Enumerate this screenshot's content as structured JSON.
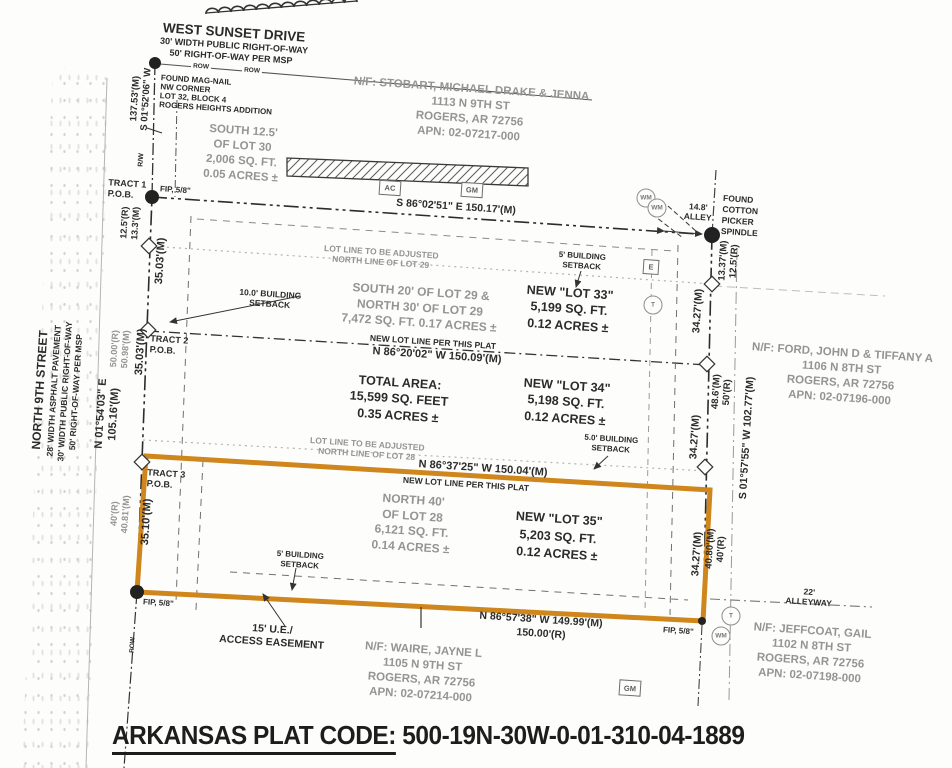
{
  "plat_code": {
    "label": "ARKANSAS PLAT CODE:",
    "value": "500-19N-30W-0-01-310-04-1889"
  },
  "streets": {
    "west_sunset": {
      "name": "WEST SUNSET DRIVE",
      "sub1": "30' WIDTH PUBLIC RIGHT-OF-WAY",
      "sub2": "50' RIGHT-OF-WAY PER MSP"
    },
    "north_9th": {
      "name": "NORTH 9TH STREET",
      "sub1": "28' WIDTH ASPHALT PAVEMENT",
      "sub2": "30' WIDTH PUBLIC RIGHT-OF-WAY",
      "sub3": "50' RIGHT-OF-WAY PER MSP"
    },
    "row": "ROW",
    "rw": "R/W",
    "alley": {
      "line1": "14.8'",
      "line2": "ALLEY"
    },
    "alleyway": {
      "line1": "22'",
      "line2": "ALLEYWAY"
    }
  },
  "corners": {
    "mag_nail": [
      "FOUND MAG-NAIL",
      "NW CORNER",
      "LOT 32, BLOCK 4",
      "ROGERS HEIGHTS ADDITION"
    ],
    "spindle": [
      "FOUND",
      "COTTON",
      "PICKER",
      "SPINDLE"
    ],
    "fip": "FIP, 5/8\""
  },
  "tracts": {
    "t1": {
      "line1": "TRACT 1",
      "line2": "P.O.B."
    },
    "t2": {
      "line1": "TRACT 2",
      "line2": "P.O.B."
    },
    "t3": {
      "line1": "TRACT 3",
      "line2": "P.O.B."
    }
  },
  "neighbors": {
    "stobart": [
      "N/F: STOBART, MICHAEL DRAKE & JENNA",
      "1113 N 9TH ST",
      "ROGERS, AR 72756",
      "APN: 02-07217-000"
    ],
    "ford": [
      "N/F: FORD, JOHN D & TIFFANY A",
      "1106 N 8TH ST",
      "ROGERS, AR 72756",
      "APN: 02-07196-000"
    ],
    "waire": [
      "N/F: WAIRE, JAYNE L",
      "1105 N 9TH ST",
      "ROGERS, AR 72756",
      "APN: 02-07214-000"
    ],
    "jeffcoat": [
      "N/F: JEFFCOAT, GAIL",
      "1102 N 8TH ST",
      "ROGERS, AR 72756",
      "APN: 02-07198-000"
    ]
  },
  "lots": {
    "lot30": [
      "SOUTH 12.5'",
      "OF LOT 30",
      "2,006 SQ. FT.",
      "0.05 ACRES ±"
    ],
    "lot29": [
      "SOUTH 20' OF LOT 29 &",
      "NORTH 30' OF LOT 29",
      "7,472 SQ. FT. 0.17 ACRES ±"
    ],
    "lot28": [
      "NORTH 40'",
      "OF LOT 28",
      "6,121 SQ. FT.",
      "0.14 ACRES ±"
    ],
    "new33": [
      "NEW \"LOT 33\"",
      "5,199 SQ. FT.",
      "0.12 ACRES ±"
    ],
    "new34": [
      "NEW \"LOT 34\"",
      "5,198 SQ. FT.",
      "0.12 ACRES ±"
    ],
    "new35": [
      "NEW \"LOT 35\"",
      "5,203 SQ. FT.",
      "0.12 ACRES ±"
    ],
    "total": [
      "TOTAL AREA:",
      "15,599 SQ. FEET",
      "0.35 ACRES ±"
    ]
  },
  "notes": {
    "adjust29": {
      "line1": "LOT LINE TO BE ADJUSTED",
      "line2": "NORTH LINE OF LOT 29"
    },
    "adjust28": {
      "line1": "LOT LINE TO BE ADJUSTED",
      "line2": "NORTH LINE OF LOT 28"
    },
    "new_lot_line": "NEW LOT LINE PER THIS PLAT",
    "setback10": {
      "line1": "10.0' BUILDING",
      "line2": "SETBACK"
    },
    "setback5a": {
      "line1": "5' BUILDING",
      "line2": "SETBACK"
    },
    "setback5b": {
      "line1": "5.0' BUILDING",
      "line2": "SETBACK"
    },
    "easement": {
      "line1": "15' U.E./",
      "line2": "ACCESS EASEMENT"
    }
  },
  "bearings": {
    "north": "S 86°02'51\" E  150.17'(M)",
    "lot29_new": "N 86°20'02\" W  150.09'(M)",
    "lot28_new": "N 86°37'25\" W  150.04'(M)",
    "south": "N 86°57'38\" W  149.99'(M)",
    "south_r": "150.00'(R)",
    "west_upper": {
      "line1": "137.53'(M)",
      "line2": "S 01°52'06\" W"
    },
    "west_main": {
      "line1": "N 01°54'03\" E",
      "line2": "105.16'(M)"
    },
    "east_main": "S 01°57'55\" W  102.77'(M)"
  },
  "measurements": {
    "w1": {
      "line1": "12.5'(R)",
      "line2": "13.3'(M)"
    },
    "w2": "35.03'(M)",
    "w3": {
      "line1": "50.00'(R)",
      "line2": "50.98'(M)"
    },
    "w4": "35.03'(M)",
    "w5": {
      "line1": "40'(R)",
      "line2": "40.81'(M)"
    },
    "w6": "35.10'(M)",
    "e1": {
      "line1": "13.37'(M)",
      "line2": "12.5'(R)"
    },
    "e2": "34.27'(M)",
    "e3": {
      "line1": "48.6'(M)",
      "line2": "50'(R)"
    },
    "e4": "34.27'(M)",
    "e5": {
      "line1": "40.80'(M)",
      "line2": "40'(R)"
    },
    "e6": "34.27'(M)"
  },
  "symbols": {
    "ac": "AC",
    "gm": "GM",
    "e": "E",
    "t": "T",
    "wm": "WM"
  },
  "colors": {
    "highlight": "#cf861c",
    "gray_text": "#949494",
    "black_text": "#2b2b2b"
  }
}
